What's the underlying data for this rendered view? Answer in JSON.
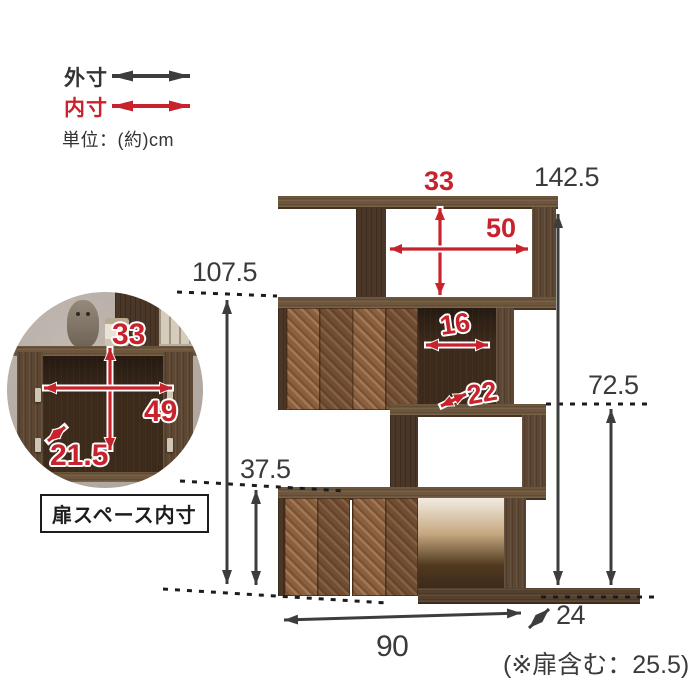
{
  "legend": {
    "outer_label": "外寸",
    "inner_label": "内寸",
    "unit_label": "単位：(約)cm"
  },
  "dimensions_cm": {
    "outer": {
      "total_height": "142.5",
      "upper_shelf_height": "107.5",
      "middle_shelf_height": "72.5",
      "lower_shelf_height": "37.5",
      "width": "90",
      "depth": "24",
      "depth_note": "(※扉含む：25.5)"
    },
    "inner": {
      "top_compartment_height": "33",
      "top_compartment_width": "50",
      "middle_opening_width": "16",
      "middle_shelf_depth": "22"
    }
  },
  "inset": {
    "caption": "扉スペース内寸",
    "inner_height": "33",
    "inner_width": "49",
    "inner_depth": "21.5"
  },
  "colors": {
    "accent_red": "#c8232c",
    "arrow_black": "#3d3d3d",
    "wood_dark": "#5d4733",
    "wood_door": "#8a6040"
  }
}
